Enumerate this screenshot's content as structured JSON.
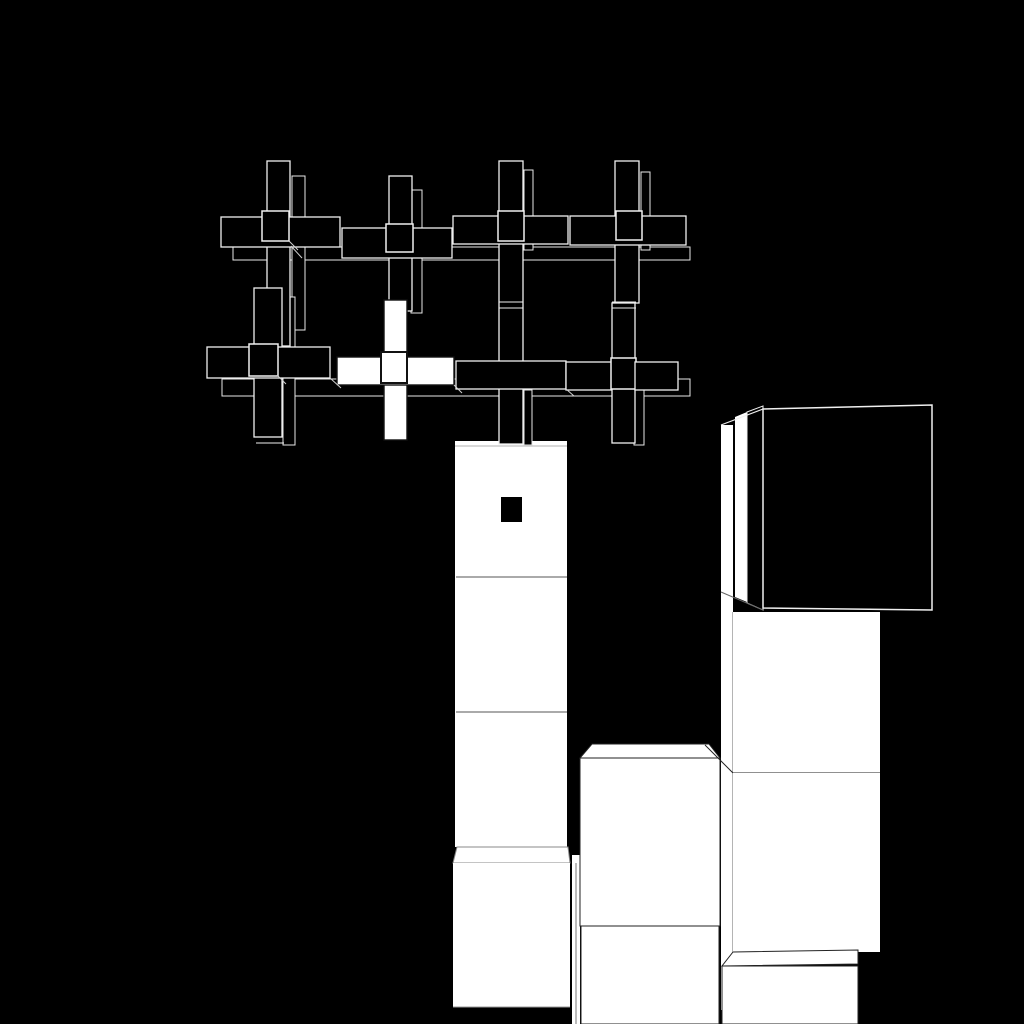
{
  "scene": {
    "width": 1024,
    "height": 1024,
    "background": "#000000",
    "palette": {
      "black": "#000000",
      "white": "#ffffff",
      "outline_light": "#f0f0f0",
      "outline_dupe": "#e8e8e8",
      "outline_dark": "#222222",
      "outline_gray": "#888888",
      "line_faint": "#999999",
      "line_mid": "#777777",
      "line_dim": "#555555",
      "line_diag": "#d0d0d0",
      "ink": "#111111"
    },
    "elements": [
      {
        "name": "tower-column",
        "type": "rect",
        "x": 455,
        "y": 441,
        "w": 112,
        "h": 406,
        "fill": "#ffffff"
      },
      {
        "name": "tower-top-face-edge",
        "type": "line",
        "x1": 455,
        "y1": 446,
        "x2": 567,
        "y2": 446,
        "stroke": "#999999",
        "sw": 0.8
      },
      {
        "name": "tower-separator-1",
        "type": "line",
        "x1": 456,
        "y1": 577,
        "x2": 567,
        "y2": 577,
        "stroke": "#777777",
        "sw": 1.2
      },
      {
        "name": "tower-separator-2",
        "type": "line",
        "x1": 456,
        "y1": 712,
        "x2": 567,
        "y2": 712,
        "stroke": "#777777",
        "sw": 1.2
      },
      {
        "name": "tower-bottom-cube-top-face",
        "type": "polygon",
        "points": "457,847 568,847 570,863 453,863",
        "fill": "#ffffff",
        "stroke": "#888888",
        "sw": 1
      },
      {
        "name": "tower-bottom-cube-front",
        "type": "rect",
        "x": 453,
        "y": 863,
        "w": 117,
        "h": 144,
        "fill": "#ffffff"
      },
      {
        "name": "tower-bottom-cube-bottom-edge",
        "type": "line",
        "x1": 453,
        "y1": 1007,
        "x2": 570,
        "y2": 1007,
        "stroke": "#999999",
        "sw": 1
      },
      {
        "name": "tower-right-side-sliver",
        "type": "rect",
        "x": 572,
        "y": 855,
        "w": 8,
        "h": 169,
        "fill": "#ffffff"
      },
      {
        "name": "tower-right-side-sliver-line",
        "type": "line",
        "x1": 576,
        "y1": 863,
        "x2": 576,
        "y2": 1024,
        "stroke": "#555555",
        "sw": 0.8
      },
      {
        "name": "mid-cube-top-face",
        "type": "polygon",
        "points": "592,744 709,744 720,758 580,758",
        "fill": "#ffffff",
        "stroke": "#222222",
        "sw": 1
      },
      {
        "name": "mid-cube-front-upper",
        "type": "rect",
        "x": 580,
        "y": 758,
        "w": 140,
        "h": 168,
        "fill": "#ffffff",
        "stroke": "#222222",
        "sw": 1
      },
      {
        "name": "mid-cube-front-lower",
        "type": "rect",
        "x": 581,
        "y": 926,
        "w": 138,
        "h": 98,
        "fill": "#ffffff",
        "stroke": "#222222",
        "sw": 1
      },
      {
        "name": "side-sliver-band",
        "type": "rect",
        "x": 721,
        "y": 425,
        "w": 12,
        "h": 585,
        "fill": "#ffffff"
      },
      {
        "name": "side-sliver-band-right-edge",
        "type": "line",
        "x1": 733,
        "y1": 612,
        "x2": 733,
        "y2": 1010,
        "stroke": "#444444",
        "sw": 0.8
      },
      {
        "name": "side-sliver-2",
        "type": "polygon",
        "points": "735,417 747,412 747,602 735,597",
        "fill": "#ffffff"
      },
      {
        "name": "black-cube-side-face",
        "type": "polygon",
        "points": "747,412 763,406 763,610 747,603",
        "fill": "#000000",
        "stroke": "#f0f0f0",
        "sw": 1
      },
      {
        "name": "black-cube-top-left-edge",
        "type": "line",
        "x1": 721,
        "y1": 425,
        "x2": 763,
        "y2": 409,
        "stroke": "#f0f0f0",
        "sw": 1.2
      },
      {
        "name": "side-sliver-bottom-diagonal",
        "type": "line",
        "x1": 721,
        "y1": 592,
        "x2": 763,
        "y2": 610,
        "stroke": "#666666",
        "sw": 1
      },
      {
        "name": "black-cube-front-face",
        "type": "polygon",
        "points": "763,409 932,405 932,610 763,608",
        "fill": "#000000",
        "stroke": "#f0f0f0",
        "sw": 1.5
      },
      {
        "name": "right-column-face-upper",
        "type": "rect",
        "x": 733,
        "y": 612,
        "w": 147,
        "h": 161,
        "fill": "#ffffff"
      },
      {
        "name": "right-column-separator",
        "type": "line",
        "x1": 733,
        "y1": 773,
        "x2": 880,
        "y2": 773,
        "stroke": "#222222",
        "sw": 1
      },
      {
        "name": "right-column-face-lower",
        "type": "rect",
        "x": 733,
        "y": 773,
        "w": 147,
        "h": 179,
        "fill": "#ffffff"
      },
      {
        "name": "right-column-top-face-diagonal",
        "type": "line",
        "x1": 705,
        "y1": 745,
        "x2": 733,
        "y2": 773,
        "stroke": "#222222",
        "sw": 1
      },
      {
        "name": "bottom-right-cube-top-face",
        "type": "polygon",
        "points": "733,952 858,950 858,964 722,966",
        "fill": "#ffffff",
        "stroke": "#222222",
        "sw": 1
      },
      {
        "name": "bottom-right-cube-front",
        "type": "rect",
        "x": 722,
        "y": 966,
        "w": 136,
        "h": 58,
        "fill": "#ffffff",
        "stroke": "#222222",
        "sw": 1
      },
      {
        "name": "cross-dupe-band-top",
        "type": "rect",
        "x": 233,
        "y": 247,
        "w": 457,
        "h": 13,
        "fill": "#000000",
        "stroke": "#e8e8e8",
        "sw": 1
      },
      {
        "name": "cross-dupe-band-bottom",
        "type": "rect",
        "x": 222,
        "y": 379,
        "w": 468,
        "h": 17,
        "fill": "#000000",
        "stroke": "#e8e8e8",
        "sw": 1
      },
      {
        "name": "cross-1-dupe-vbar",
        "type": "rect",
        "x": 292,
        "y": 176,
        "w": 13,
        "h": 154,
        "fill": "#000000",
        "stroke": "#e8e8e8",
        "sw": 1
      },
      {
        "name": "cross-2-dupe-vbar",
        "type": "rect",
        "x": 411,
        "y": 190,
        "w": 11,
        "h": 123,
        "fill": "#000000",
        "stroke": "#e8e8e8",
        "sw": 1
      },
      {
        "name": "cross-3-dupe-vbar",
        "type": "rect",
        "x": 524,
        "y": 170,
        "w": 9,
        "h": 80,
        "fill": "#000000",
        "stroke": "#e8e8e8",
        "sw": 1
      },
      {
        "name": "cross-4-dupe-vbar",
        "type": "rect",
        "x": 641,
        "y": 172,
        "w": 9,
        "h": 78,
        "fill": "#000000",
        "stroke": "#e8e8e8",
        "sw": 1
      },
      {
        "name": "cross-5-dupe-vbar",
        "type": "rect",
        "x": 283,
        "y": 297,
        "w": 12,
        "h": 148,
        "fill": "#000000",
        "stroke": "#e8e8e8",
        "sw": 1
      },
      {
        "name": "cross-7-dupe-vbar",
        "type": "rect",
        "x": 524,
        "y": 390,
        "w": 8,
        "h": 55,
        "fill": "#000000",
        "stroke": "#e8e8e8",
        "sw": 1
      },
      {
        "name": "cross-8-dupe-vbar",
        "type": "rect",
        "x": 634,
        "y": 390,
        "w": 10,
        "h": 55,
        "fill": "#000000",
        "stroke": "#e8e8e8",
        "sw": 1
      },
      {
        "name": "cross-1-vbar",
        "type": "rect",
        "x": 267,
        "y": 161,
        "w": 23,
        "h": 185,
        "fill": "#000000",
        "stroke": "#f0f0f0",
        "sw": 1.3
      },
      {
        "name": "cross-1-hbar",
        "type": "rect",
        "x": 221,
        "y": 217,
        "w": 119,
        "h": 30,
        "fill": "#000000",
        "stroke": "#f0f0f0",
        "sw": 1.3
      },
      {
        "name": "cross-1-center-cube",
        "type": "rect",
        "x": 262,
        "y": 211,
        "w": 27,
        "h": 30,
        "fill": "#000000",
        "stroke": "#f0f0f0",
        "sw": 1.5
      },
      {
        "name": "cross-2-vbar",
        "type": "rect",
        "x": 389,
        "y": 176,
        "w": 23,
        "h": 135,
        "fill": "#000000",
        "stroke": "#f0f0f0",
        "sw": 1.3
      },
      {
        "name": "cross-2-hbar",
        "type": "rect",
        "x": 342,
        "y": 228,
        "w": 110,
        "h": 30,
        "fill": "#000000",
        "stroke": "#f0f0f0",
        "sw": 1.3
      },
      {
        "name": "cross-2-center-cube",
        "type": "rect",
        "x": 386,
        "y": 224,
        "w": 27,
        "h": 28,
        "fill": "#000000",
        "stroke": "#f0f0f0",
        "sw": 1.5
      },
      {
        "name": "cross-3-vbar",
        "type": "rect",
        "x": 499,
        "y": 161,
        "w": 24,
        "h": 283,
        "fill": "#000000",
        "stroke": "#f0f0f0",
        "sw": 1.3
      },
      {
        "name": "cross-3-hbar",
        "type": "rect",
        "x": 453,
        "y": 216,
        "w": 115,
        "h": 28,
        "fill": "#000000",
        "stroke": "#f0f0f0",
        "sw": 1.3
      },
      {
        "name": "cross-3-center-cube",
        "type": "rect",
        "x": 498,
        "y": 211,
        "w": 26,
        "h": 30,
        "fill": "#000000",
        "stroke": "#f0f0f0",
        "sw": 1.5
      },
      {
        "name": "cross-4-vbar",
        "type": "rect",
        "x": 615,
        "y": 161,
        "w": 24,
        "h": 142,
        "fill": "#000000",
        "stroke": "#f0f0f0",
        "sw": 1.3
      },
      {
        "name": "cross-4-hbar",
        "type": "rect",
        "x": 570,
        "y": 216,
        "w": 116,
        "h": 29,
        "fill": "#000000",
        "stroke": "#f0f0f0",
        "sw": 1.3
      },
      {
        "name": "cross-4-center-cube",
        "type": "rect",
        "x": 616,
        "y": 211,
        "w": 26,
        "h": 29,
        "fill": "#000000",
        "stroke": "#f0f0f0",
        "sw": 1.5
      },
      {
        "name": "cross-5-vbar",
        "type": "rect",
        "x": 254,
        "y": 288,
        "w": 28,
        "h": 149,
        "fill": "#000000",
        "stroke": "#f0f0f0",
        "sw": 1.3
      },
      {
        "name": "cross-5-hbar",
        "type": "rect",
        "x": 207,
        "y": 347,
        "w": 123,
        "h": 31,
        "fill": "#000000",
        "stroke": "#f0f0f0",
        "sw": 1.3
      },
      {
        "name": "cross-5-center-cube",
        "type": "rect",
        "x": 249,
        "y": 344,
        "w": 29,
        "h": 32,
        "fill": "#000000",
        "stroke": "#f0f0f0",
        "sw": 1.5
      },
      {
        "name": "cross-6-white-vbar",
        "type": "rect",
        "x": 384,
        "y": 300,
        "w": 23,
        "h": 140,
        "fill": "#ffffff",
        "stroke": "#111111",
        "sw": 1.4
      },
      {
        "name": "cross-6-white-hbar",
        "type": "rect",
        "x": 337,
        "y": 357,
        "w": 117,
        "h": 28,
        "fill": "#ffffff",
        "stroke": "#111111",
        "sw": 1.4
      },
      {
        "name": "cross-6-white-center-cube",
        "type": "rect",
        "x": 381,
        "y": 352,
        "w": 26,
        "h": 31,
        "fill": "#ffffff",
        "stroke": "#111111",
        "sw": 2
      },
      {
        "name": "cross-7-hbar",
        "type": "rect",
        "x": 456,
        "y": 361,
        "w": 110,
        "h": 28,
        "fill": "#000000",
        "stroke": "#f0f0f0",
        "sw": 1.3
      },
      {
        "name": "cross-7-8-connector",
        "type": "rect",
        "x": 566,
        "y": 362,
        "w": 47,
        "h": 28,
        "fill": "#000000",
        "stroke": "#f0f0f0",
        "sw": 1.3
      },
      {
        "name": "cross-8-vbar",
        "type": "rect",
        "x": 612,
        "y": 303,
        "w": 23,
        "h": 140,
        "fill": "#000000",
        "stroke": "#f0f0f0",
        "sw": 1.3
      },
      {
        "name": "cross-8-center-cube",
        "type": "rect",
        "x": 611,
        "y": 358,
        "w": 25,
        "h": 31,
        "fill": "#000000",
        "stroke": "#f0f0f0",
        "sw": 1.5
      },
      {
        "name": "cross-8-hbar-right",
        "type": "rect",
        "x": 635,
        "y": 362,
        "w": 43,
        "h": 28,
        "fill": "#000000",
        "stroke": "#f0f0f0",
        "sw": 1.3
      },
      {
        "name": "vbar-break-line-1",
        "type": "line",
        "x1": 499,
        "y1": 302,
        "x2": 523,
        "y2": 302,
        "stroke": "#f0f0f0",
        "sw": 1
      },
      {
        "name": "vbar-break-line-2",
        "type": "line",
        "x1": 499,
        "y1": 308,
        "x2": 523,
        "y2": 308,
        "stroke": "#f0f0f0",
        "sw": 1
      },
      {
        "name": "vbar-break-line-3",
        "type": "line",
        "x1": 612,
        "y1": 302,
        "x2": 636,
        "y2": 302,
        "stroke": "#f0f0f0",
        "sw": 1
      },
      {
        "name": "vbar-break-line-4",
        "type": "line",
        "x1": 612,
        "y1": 308,
        "x2": 636,
        "y2": 308,
        "stroke": "#f0f0f0",
        "sw": 1
      },
      {
        "name": "cross-5-vbar-bottom-dupe-edge",
        "type": "line",
        "x1": 256,
        "y1": 443,
        "x2": 284,
        "y2": 443,
        "stroke": "#f0f0f0",
        "sw": 1
      },
      {
        "name": "depth-diagonal-1",
        "type": "line",
        "x1": 289,
        "y1": 241,
        "x2": 298,
        "y2": 250,
        "stroke": "#d0d0d0",
        "sw": 1
      },
      {
        "name": "depth-diagonal-2",
        "type": "line",
        "x1": 291,
        "y1": 246,
        "x2": 302,
        "y2": 258,
        "stroke": "#d0d0d0",
        "sw": 1
      },
      {
        "name": "depth-diagonal-3",
        "type": "line",
        "x1": 330,
        "y1": 378,
        "x2": 341,
        "y2": 388,
        "stroke": "#d0d0d0",
        "sw": 1
      },
      {
        "name": "depth-diagonal-4",
        "type": "line",
        "x1": 277,
        "y1": 375,
        "x2": 286,
        "y2": 384,
        "stroke": "#d0d0d0",
        "sw": 1
      },
      {
        "name": "depth-diagonal-5",
        "type": "line",
        "x1": 454,
        "y1": 385,
        "x2": 462,
        "y2": 393,
        "stroke": "#d0d0d0",
        "sw": 1
      },
      {
        "name": "depth-diagonal-6",
        "type": "line",
        "x1": 566,
        "y1": 389,
        "x2": 574,
        "y2": 396,
        "stroke": "#d0d0d0",
        "sw": 1
      },
      {
        "name": "tower-face-black-dot",
        "type": "rect",
        "x": 501,
        "y": 497,
        "w": 21,
        "h": 25,
        "fill": "#000000"
      }
    ]
  }
}
